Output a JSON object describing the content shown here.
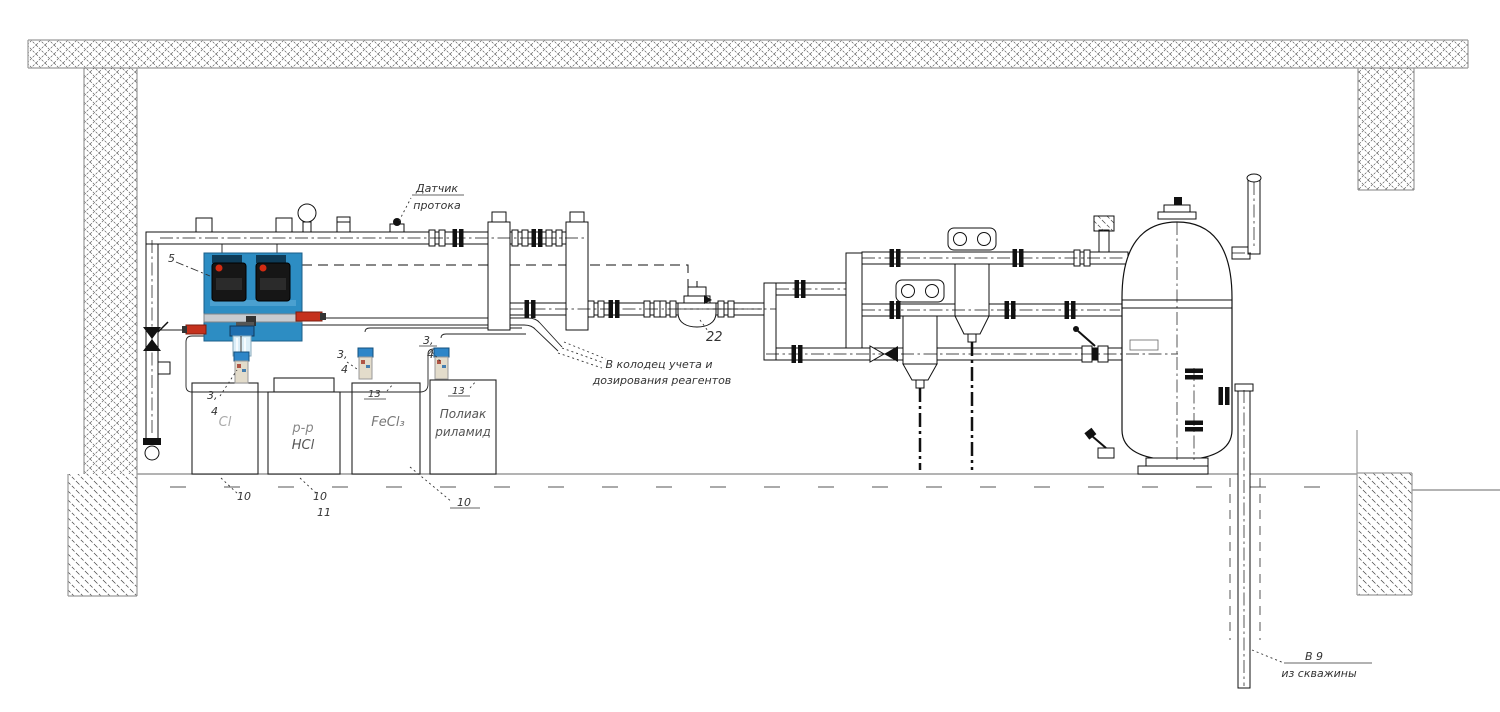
{
  "drawing": {
    "labels": {
      "flow_sensor": {
        "line1": "Датчик",
        "line2": "протока"
      },
      "to_well": {
        "line1": "В колодец учета и",
        "line2": "дозирования реагентов"
      },
      "from_well": {
        "line1": "В 9",
        "line2": "из скважины"
      }
    },
    "tanks": [
      {
        "label1": "Cl",
        "label2": ""
      },
      {
        "label1": "р-р",
        "label2": "HCl"
      },
      {
        "label1": "FeCl₃",
        "label2": ""
      },
      {
        "label1": "Полиак",
        "label2": "риламид"
      }
    ],
    "callouts": {
      "panel": "5",
      "lance1_1": "3,",
      "lance1_2": "4",
      "lance2_1": "3,",
      "lance2_2": "4",
      "lance3_1": "3,",
      "lance3_2": "4",
      "tank3_id": "13",
      "tank4_id": "13",
      "tank1_num": "10",
      "tank2_num": "10",
      "tank2_num2": "11",
      "tank34_num": "10",
      "meter": "22"
    },
    "colors": {
      "panel_blue": "#2d8dc3",
      "pump_black": "#161616",
      "accent_red": "#c5311d",
      "filter_blue": "#1f6fb0",
      "line": "#1a1a1a",
      "structure_gray": "#9a9a9a"
    }
  }
}
